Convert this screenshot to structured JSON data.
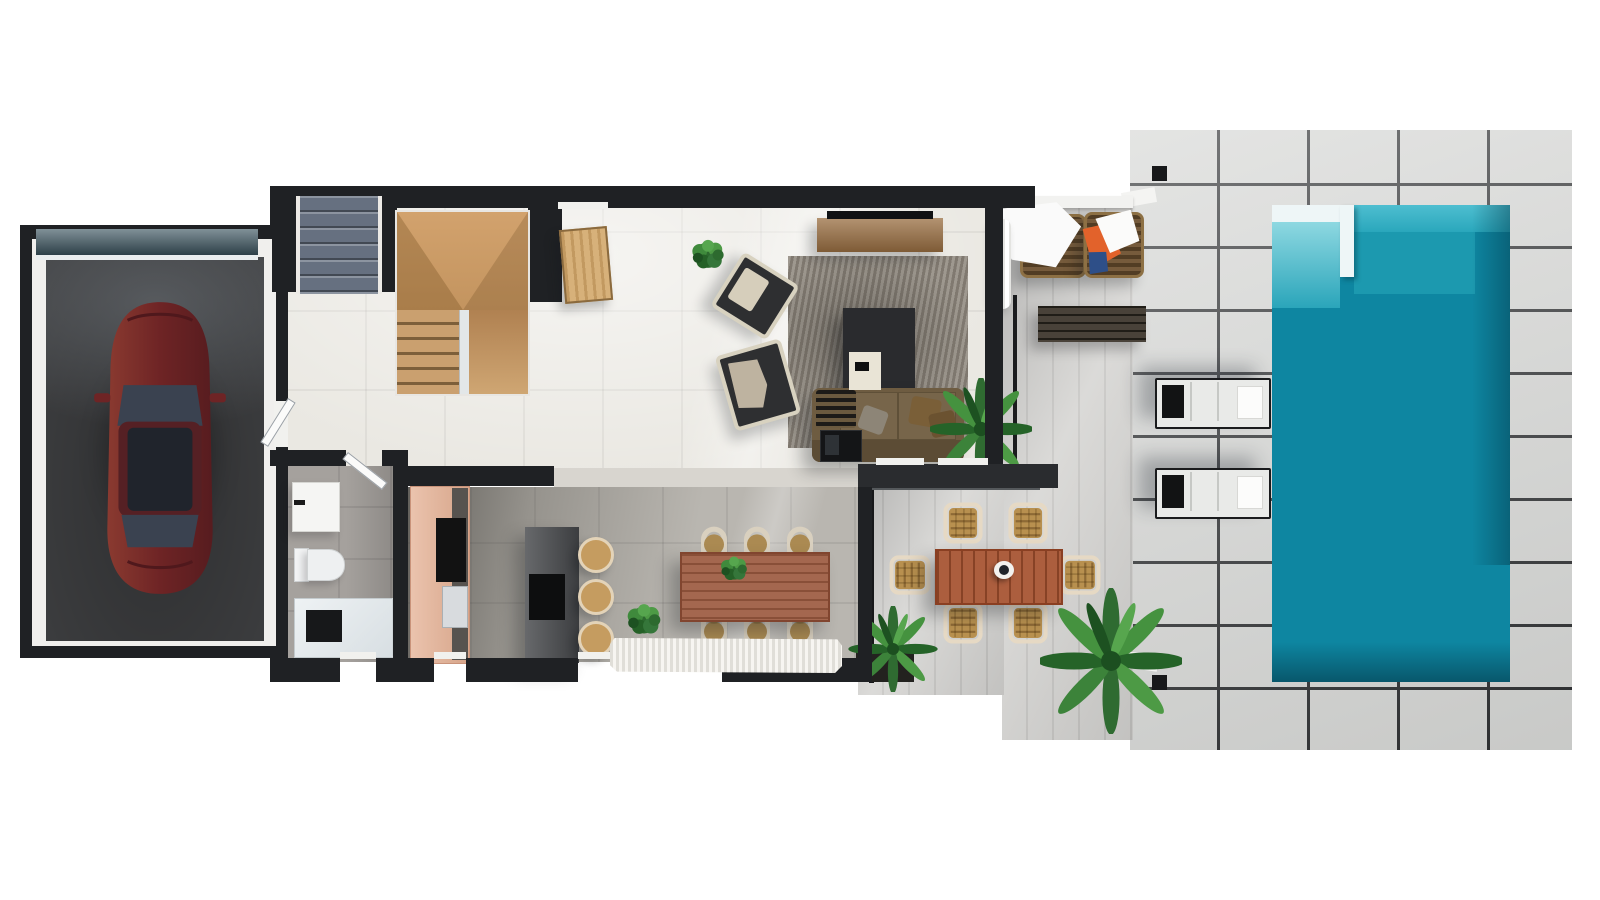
{
  "scene": {
    "description": "3D top-down floor plan rendering of a villa: garage with car, entry stairs, bathroom, open-plan kitchen / dining / living room, outdoor terrace with dining set, and a paved pool deck with swimming pool and sun loungers",
    "view": "top-down orthographic",
    "background": "#ffffff"
  },
  "palette": {
    "wall": "#1f2124",
    "indoor_floor": "#eae8e2",
    "kitchen_dining_floor": "#b9b6b0",
    "bathroom_floor": "#a5a19d",
    "garage_floor": "#3e3f41",
    "garage_door": "#3c5560",
    "terrace_floor": "#cdccc9",
    "deck_paver": "#d5d6d4",
    "deck_joint": "#2d2f31",
    "pool_water": "#0e86a1",
    "pool_shallow": "#4ebed0",
    "pool_ledge": "#eef6f7",
    "car_body": "#6e2425",
    "car_glass": "#3a4250",
    "stair_wood": "#c89b6a",
    "door_wood": "#d2a668",
    "entry_steps": "#667080",
    "sofa": "#6e5c41",
    "living_rug": "#8e877d",
    "coffee_table": "#2a2b2e",
    "tv_console": "#9a6f42",
    "dining_table": "#9c5a40",
    "dining_chair_seat": "#ab8a52",
    "dining_chair_frame": "#d9d0bf",
    "kitchen_island": "#46484b",
    "kitchen_cabinet": "#e4af92",
    "bar_stool": "#c59c60",
    "outdoor_table": "#a5502e",
    "wicker": "#b8904f",
    "towel_white": "#fafafa",
    "towel_orange": "#e2622b",
    "towel_blue": "#2e4f88",
    "lounger_body": "#e9eae8",
    "lounger_head": "#121314",
    "bench_wood": "#3b342a",
    "plant_green": "#2f6b31",
    "fringed_rug": "#f1efe8"
  },
  "rooms": [
    {
      "id": "garage",
      "label": "Garage",
      "items": [
        {
          "name": "car",
          "count": 1,
          "color_ref": "car_body"
        },
        {
          "name": "garage-door",
          "count": 1,
          "color_ref": "garage_door"
        }
      ]
    },
    {
      "id": "entry",
      "label": "Entry",
      "items": [
        {
          "name": "exterior-steps",
          "count": 1
        },
        {
          "name": "front-door",
          "count": 1,
          "color_ref": "door_wood"
        }
      ]
    },
    {
      "id": "staircase",
      "label": "Staircase",
      "items": [
        {
          "name": "landing",
          "count": 1
        },
        {
          "name": "stair-flight",
          "count": 2
        }
      ]
    },
    {
      "id": "bathroom",
      "label": "Bathroom",
      "items": [
        {
          "name": "washbasin",
          "count": 1
        },
        {
          "name": "toilet",
          "count": 1
        },
        {
          "name": "walk-in-shower",
          "count": 1
        }
      ]
    },
    {
      "id": "kitchen",
      "label": "Kitchen",
      "items": [
        {
          "name": "cabinet-run",
          "count": 1,
          "color_ref": "kitchen_cabinet"
        },
        {
          "name": "cooktop",
          "count": 2
        },
        {
          "name": "sink",
          "count": 1
        },
        {
          "name": "island",
          "count": 1,
          "color_ref": "kitchen_island"
        },
        {
          "name": "bar-stool",
          "count": 3,
          "color_ref": "bar_stool"
        }
      ]
    },
    {
      "id": "dining",
      "label": "Dining area",
      "items": [
        {
          "name": "dining-table",
          "count": 1,
          "color_ref": "dining_table"
        },
        {
          "name": "dining-chair",
          "count": 6
        },
        {
          "name": "fringed-rug",
          "count": 1
        },
        {
          "name": "potted-plant",
          "count": 2
        }
      ]
    },
    {
      "id": "living",
      "label": "Living room",
      "items": [
        {
          "name": "sofa",
          "count": 1,
          "color_ref": "sofa"
        },
        {
          "name": "coffee-table",
          "count": 1
        },
        {
          "name": "white-tray",
          "count": 1
        },
        {
          "name": "area-rug",
          "count": 1
        },
        {
          "name": "tv-console",
          "count": 1
        },
        {
          "name": "tv",
          "count": 1
        },
        {
          "name": "lounge-chair",
          "count": 2
        },
        {
          "name": "palm-plant",
          "count": 1
        },
        {
          "name": "sliding-glass-door",
          "count": 1
        }
      ]
    },
    {
      "id": "terrace",
      "label": "Terrace",
      "items": [
        {
          "name": "outdoor-dining-table",
          "count": 1,
          "color_ref": "outdoor_table"
        },
        {
          "name": "wicker-dining-chair",
          "count": 6
        },
        {
          "name": "wicker-armchair",
          "count": 2
        },
        {
          "name": "towel",
          "count": 3
        },
        {
          "name": "bench",
          "count": 1
        },
        {
          "name": "outdoor-shower-pole",
          "count": 1
        },
        {
          "name": "curtain",
          "count": 1
        },
        {
          "name": "palm-plant",
          "count": 2
        }
      ]
    },
    {
      "id": "pool-deck",
      "label": "Pool deck",
      "items": [
        {
          "name": "swimming-pool",
          "count": 1,
          "color_ref": "pool_water"
        },
        {
          "name": "pool-ledge",
          "count": 1
        },
        {
          "name": "sun-lounger",
          "count": 2
        },
        {
          "name": "palm-plant",
          "count": 1
        }
      ]
    }
  ]
}
